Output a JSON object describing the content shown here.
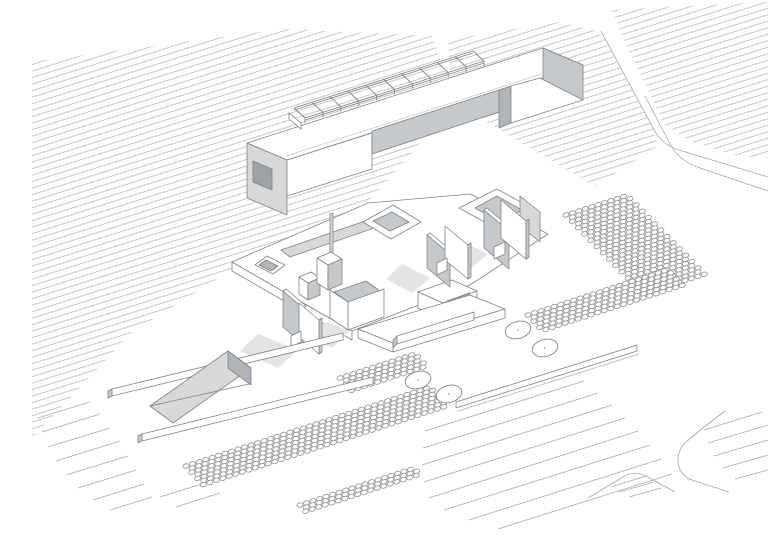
{
  "canvas": {
    "width": 768,
    "height": 543,
    "background": "#ffffff"
  },
  "palette": {
    "white": "#ffffff",
    "l1": "#d6d8da",
    "l2": "#c6c9cc",
    "l3": "#b2b5b8",
    "l4": "#a0a3a6",
    "shadow": "#e2e4e6",
    "edge": "#7f8285",
    "hatch_line": "#b1b3b5",
    "road_line": "#a3a6a9",
    "field_line": "#a6a9ac",
    "dot_line": "#8f9295",
    "tree_line": "#838689",
    "soft": "#c2c5c7"
  },
  "drawing": {
    "hatch": {
      "spacing": 6.2,
      "angle": -17.5,
      "width": 0.75
    },
    "fields": [
      {
        "name": "hatch-field-main",
        "points": "32,62 283,29 432,36 448,80 434,124 416,148 368,202 248,260 132,332 32,438"
      },
      {
        "name": "hatch-field-under-bar",
        "points": "448,40 560,22 600,32 654,130 658,146 580,196 544,178 452,108"
      },
      {
        "name": "hatch-field-top-right",
        "points": "612,10 768,2 768,158 738,156 692,142 664,124 622,36"
      }
    ],
    "white_patches": [
      {
        "name": "road-diagonal-gap",
        "points": "404,96 442,96 618,200 576,206"
      }
    ],
    "road_strokes": [
      {
        "name": "road-edge-upper",
        "d": "M 601,31 L 653,128 Q 661,144 679,150 L 768,177"
      },
      {
        "name": "road-edge-lower",
        "d": "M 768,191 L 700,168 Q 679,161 670,144 L 645,96"
      },
      {
        "name": "road-corner-bottom-right",
        "d": "M 725,411 Q 697,432 685,443 Q 678,450 678,461 Q 678,472 689,479 L 729,492"
      },
      {
        "name": "traffic-island-outline",
        "d": "M 588,498 L 623,477 Q 634,470 646,476 L 675,492"
      }
    ],
    "line_fields": [
      {
        "name": "field-lines-bottom-right",
        "lines": [
          [
            425,
            431,
            584,
            381
          ],
          [
            423,
            448,
            598,
            393
          ],
          [
            422,
            465,
            612,
            405
          ],
          [
            424,
            482,
            625,
            418
          ],
          [
            429,
            498,
            638,
            431
          ],
          [
            444,
            510,
            650,
            445
          ],
          [
            469,
            520,
            661,
            459
          ],
          [
            498,
            529,
            672,
            474
          ]
        ]
      },
      {
        "name": "field-lines-corner",
        "lines": [
          [
            704,
            430,
            762,
            412
          ],
          [
            708,
            443,
            768,
            425
          ],
          [
            714,
            456,
            768,
            440
          ],
          [
            723,
            468,
            768,
            455
          ],
          [
            735,
            479,
            768,
            470
          ]
        ]
      },
      {
        "name": "field-lines-island",
        "lines": [
          [
            611,
            487,
            646,
            476
          ],
          [
            619,
            492,
            654,
            482
          ],
          [
            629,
            497,
            661,
            488
          ]
        ]
      },
      {
        "name": "field-lines-fringe-left",
        "lines": [
          [
            38,
            418,
            90,
            402
          ],
          [
            42,
            432,
            100,
            414
          ],
          [
            48,
            447,
            110,
            428
          ],
          [
            56,
            461,
            120,
            441
          ],
          [
            66,
            475,
            128,
            456
          ],
          [
            78,
            488,
            136,
            470
          ],
          [
            93,
            500,
            144,
            484
          ],
          [
            110,
            510,
            152,
            497
          ],
          [
            160,
            497,
            208,
            482
          ],
          [
            176,
            507,
            220,
            493
          ]
        ]
      }
    ],
    "dot_grids": [
      {
        "name": "planting-grid-top-right",
        "origin": [
          566,
          215
        ],
        "u": [
          6.4,
          -2.05
        ],
        "v": [
          3.1,
          3.15
        ],
        "cols": 10,
        "rows": 26
      },
      {
        "name": "planting-grid-right",
        "origin": [
          528,
          315
        ],
        "u": [
          6.5,
          -2.1
        ],
        "v": [
          2.9,
          3.1
        ],
        "cols": 22,
        "rows": 6
      },
      {
        "name": "planting-grid-bottom",
        "origin": [
          186,
          466
        ],
        "u": [
          6.5,
          -2.1
        ],
        "v": [
          2.9,
          3.1
        ],
        "cols": 38,
        "rows": 7
      },
      {
        "name": "planting-grid-mid",
        "origin": [
          340,
          378
        ],
        "u": [
          6.5,
          -2.1
        ],
        "v": [
          2.9,
          3.1
        ],
        "cols": 12,
        "rows": 5
      },
      {
        "name": "planting-grid-bottom-low",
        "origin": [
          300,
          505
        ],
        "u": [
          6.5,
          -2.1
        ],
        "v": [
          2.9,
          3.1
        ],
        "cols": 18,
        "rows": 3
      }
    ],
    "dot_style": {
      "rx": 3.1,
      "ry": 2.2,
      "rotate": -17
    },
    "trees": [
      {
        "cx": 518,
        "cy": 330
      },
      {
        "cx": 545,
        "cy": 348
      },
      {
        "cx": 418,
        "cy": 380
      },
      {
        "cx": 449,
        "cy": 394
      }
    ],
    "tree_style": {
      "rx": 13,
      "ry": 8.5,
      "rotate": -15
    },
    "structures": [
      {
        "n": "plinth-front-face",
        "p": "232,262 352,331 352,340 232,271",
        "f": "white"
      },
      {
        "n": "plinth-top",
        "p": "232,262 368,203 470,194 548,234 470,285 352,331",
        "f": "white"
      },
      {
        "n": "courtyard-square-rim",
        "p": "267,256 285,265 273,274 255,265",
        "f": "white"
      },
      {
        "n": "courtyard-square-hole",
        "p": "266,260 278,266 271,271 259,265",
        "f": "l3"
      },
      {
        "n": "plinth-long-recess",
        "p": "281,250 368,220 377,227 290,257",
        "f": "l1"
      },
      {
        "n": "courtyard-ring-1-rim",
        "p": "393,205 421,222 391,239 363,222",
        "f": "white"
      },
      {
        "n": "courtyard-ring-1-hole",
        "p": "392,212 409,222 390,231 373,221",
        "f": "l2"
      },
      {
        "n": "courtyard-ring-2-rim",
        "p": "497,189 537,211 499,230 459,208",
        "f": "white"
      },
      {
        "n": "courtyard-ring-2-hole",
        "p": "497,196 522,210 500,222 475,208",
        "f": "l2"
      },
      {
        "n": "shadow-left-panels",
        "p": "258,334 298,350 278,368 240,351",
        "f": "shadow",
        "ns": 1
      },
      {
        "n": "shadow-c-box",
        "p": "326,322 350,331 332,348 310,338",
        "f": "shadow",
        "ns": 1
      },
      {
        "n": "shadow-wall-pair-1",
        "p": "402,264 430,278 412,293 386,279",
        "f": "shadow",
        "ns": 1
      },
      {
        "n": "shadow-wall-pair-2",
        "p": "460,240 488,254 470,269 444,255",
        "f": "shadow",
        "ns": 1
      },
      {
        "n": "panel-a",
        "p": "283,291 303,308 303,344 283,327",
        "f": "l2"
      },
      {
        "n": "panel-a-top",
        "p": "283,291 303,308 306,306 286,289",
        "f": "white"
      },
      {
        "n": "panel-b",
        "p": "299,303 319,320 319,354 299,337",
        "f": "white"
      },
      {
        "n": "panel-b-side",
        "p": "319,320 322,318 322,352 319,354",
        "f": "l2"
      },
      {
        "n": "panel-stub",
        "p": "291,336 301,331 301,342 291,347",
        "f": "white"
      },
      {
        "n": "c-box-inner",
        "p": "334,292 366,281 380,291 348,302",
        "f": "l2"
      },
      {
        "n": "c-box-front-r",
        "p": "348,302 384,289 384,317 348,330",
        "f": "white"
      },
      {
        "n": "c-box-front-l",
        "p": "330,290 348,302 348,330 330,318",
        "f": "white"
      },
      {
        "n": "frame-box-top",
        "p": "418,292 452,280 477,291 443,303",
        "f": "white"
      },
      {
        "n": "frame-box-left",
        "p": "418,292 443,303 443,319 418,308",
        "f": "white"
      },
      {
        "n": "frame-box-right",
        "p": "443,303 477,291 477,307 443,319",
        "f": "white"
      },
      {
        "n": "frame-box-opening",
        "p": "447,301 469,293 469,305 447,313",
        "f": "l4"
      },
      {
        "n": "small-box-top",
        "p": "299,277 311,272 320,278 308,283",
        "f": "white"
      },
      {
        "n": "small-box-left",
        "p": "299,277 308,283 308,300 299,294",
        "f": "white"
      },
      {
        "n": "small-box-right",
        "p": "308,283 320,278 320,295 308,300",
        "f": "l2"
      },
      {
        "n": "tower-mast",
        "p": "330,214 333,213 333,257 330,258",
        "f": "l1"
      },
      {
        "n": "tower-top",
        "p": "317,258 331,252 342,259 328,265",
        "f": "white"
      },
      {
        "n": "tower-left",
        "p": "317,258 328,265 328,290 317,283",
        "f": "white"
      },
      {
        "n": "tower-right",
        "p": "328,265 342,259 342,284 328,290",
        "f": "l2"
      },
      {
        "n": "wall-a",
        "p": "427,235 450,254 450,287 427,268",
        "f": "l2"
      },
      {
        "n": "wall-a-top",
        "p": "427,235 450,254 453,252 430,233",
        "f": "white"
      },
      {
        "n": "wall-b",
        "p": "445,226 468,245 468,279 445,260",
        "f": "white"
      },
      {
        "n": "wall-b-side",
        "p": "468,245 471,243 471,277 468,279",
        "f": "l2"
      },
      {
        "n": "wall-stub-1",
        "p": "437,263 447,258 447,270 437,275",
        "f": "white"
      },
      {
        "n": "wall-e-back",
        "p": "520,196 540,212 540,242 520,226",
        "f": "l1"
      },
      {
        "n": "wall-c",
        "p": "484,210 509,231 509,269 484,248",
        "f": "l2"
      },
      {
        "n": "wall-c-top",
        "p": "484,210 509,231 512,229 487,208",
        "f": "white"
      },
      {
        "n": "wall-d",
        "p": "501,200 526,221 526,259 501,238",
        "f": "white"
      },
      {
        "n": "wall-d-side",
        "p": "526,221 529,219 529,257 526,259",
        "f": "l2"
      },
      {
        "n": "wall-stub-2",
        "p": "494,247 505,242 505,254 494,259",
        "f": "white"
      },
      {
        "n": "lower-plinth-top",
        "p": "358,329 470,295 505,309 393,343",
        "f": "white"
      },
      {
        "n": "lower-plinth-front-l",
        "p": "358,329 393,343 393,352 358,338",
        "f": "white"
      },
      {
        "n": "lower-plinth-front-r",
        "p": "393,343 505,309 505,318 393,352",
        "f": "white"
      },
      {
        "n": "lower-plinth-wall",
        "p": "397,336 474,312 474,320 397,344",
        "f": "white"
      },
      {
        "n": "lower-plinth-wall-end",
        "p": "393,340 397,336 397,344 393,348",
        "f": "l2"
      },
      {
        "n": "long-wall-3",
        "p": "456,402 637,345 637,351 456,408",
        "f": "white"
      },
      {
        "n": "long-wall-1",
        "p": "112,389 343,333 343,340 112,396",
        "f": "white"
      },
      {
        "n": "long-wall-1-end",
        "p": "108,391 112,389 112,396 108,398",
        "f": "l2"
      },
      {
        "n": "ramp-wedge-face",
        "p": "150,406 228,351 251,368 173,423",
        "f": "l1"
      },
      {
        "n": "ramp-wedge-inner",
        "p": "228,351 251,368 251,385 228,368",
        "f": "l3"
      },
      {
        "n": "long-wall-2",
        "p": "142,434 373,377 373,384 142,441",
        "f": "white"
      },
      {
        "n": "long-wall-2-end",
        "p": "138,436 142,434 142,441 138,443",
        "f": "l2"
      },
      {
        "n": "bar-roof",
        "p": "247,143 543,48 583,65 287,160",
        "f": "white"
      },
      {
        "n": "bar-right-end",
        "p": "543,48 583,65 583,100 543,83",
        "f": "l2"
      },
      {
        "n": "bar-left-leg",
        "p": "247,143 287,160 287,215 247,198",
        "f": "l1"
      },
      {
        "n": "bar-leg-opening",
        "p": "253,161 272,169 272,190 253,182",
        "f": "l4"
      },
      {
        "n": "bar-front-left",
        "p": "287,160 372,133 372,169 287,196",
        "f": "white"
      },
      {
        "n": "bar-notch-back",
        "p": "372,131 499,90 499,112 372,154",
        "f": "l2"
      },
      {
        "n": "bar-notch-jamb",
        "p": "499,90 511,86 511,123 499,128",
        "f": "l3"
      },
      {
        "n": "bar-front-right",
        "p": "511,86 540,78 583,100 511,123",
        "f": "white"
      }
    ],
    "extra_strokes": [
      {
        "n": "bar-roof-edge-line",
        "d": "M 286,156 L 579,62",
        "c": "soft",
        "w": 0.7
      },
      {
        "n": "ramp-crease-line",
        "d": "M 150,406 L 249,384",
        "c": "edge",
        "w": 0.7
      },
      {
        "n": "wall-3-ground-line",
        "d": "M 458,411 L 639,354",
        "c": "soft",
        "w": 1.0
      }
    ],
    "ladder": {
      "a": [
        294,
        108
      ],
      "b": [
        473,
        51
      ],
      "v": [
        11,
        10
      ],
      "rungs": 11,
      "leg": 5,
      "step": "289,113 301,123 301,129 289,119"
    }
  }
}
